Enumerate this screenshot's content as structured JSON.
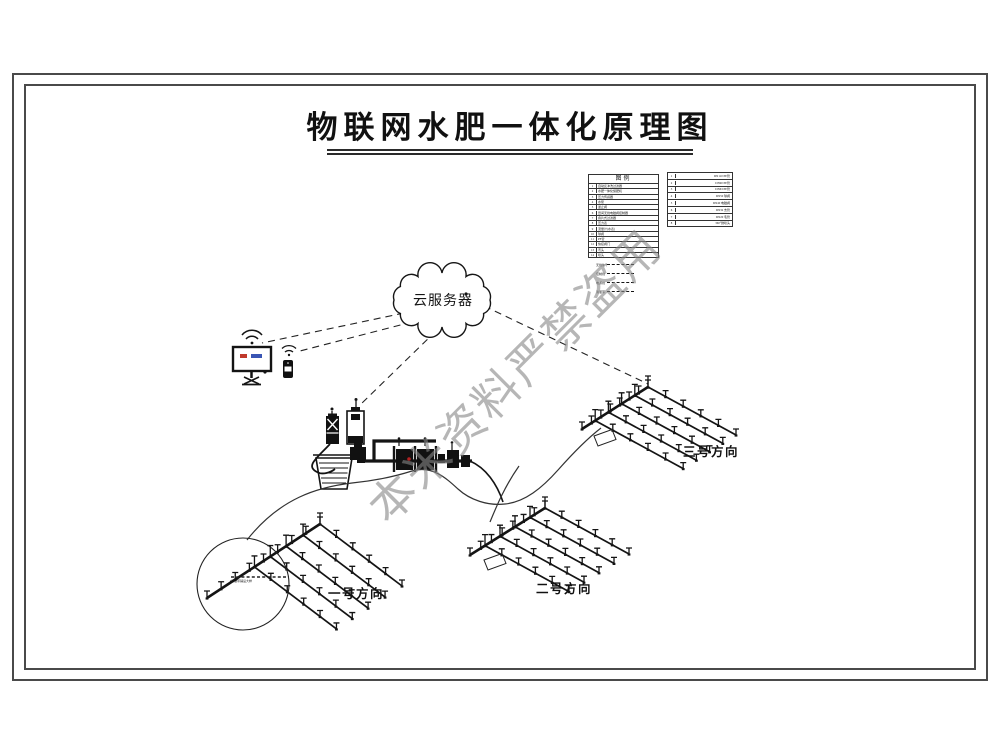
{
  "title": "物联网水肥一体化原理图",
  "watermark": "本米资料严禁盗用",
  "cloud": {
    "label": "云服务器"
  },
  "fields": [
    {
      "label": "一号方向"
    },
    {
      "label": "二号方向"
    },
    {
      "label": "三号方向"
    }
  ],
  "legend": {
    "title": "图例",
    "items": [
      {
        "no": "1",
        "name": "自动反冲洗过滤器"
      },
      {
        "no": "2",
        "name": "水肥一体化施肥机"
      },
      {
        "no": "3",
        "name": "压力传感器"
      },
      {
        "no": "4",
        "name": "水泵"
      },
      {
        "no": "5",
        "name": "逆止阀"
      },
      {
        "no": "6",
        "name": "田间无线电磁阀控制器"
      },
      {
        "no": "7",
        "name": "叠片式过滤器"
      },
      {
        "no": "8",
        "name": "压力表"
      },
      {
        "no": "9",
        "name": "流量计(水表)"
      },
      {
        "no": "10",
        "name": "球阀"
      },
      {
        "no": "11",
        "name": "PE管"
      },
      {
        "no": "12",
        "name": "快接阀门"
      },
      {
        "no": "13",
        "name": "弯头"
      },
      {
        "no": "14",
        "name": "喷头"
      }
    ]
  },
  "spec_table": {
    "rows": [
      {
        "no": "1",
        "name": "DN110 PE管"
      },
      {
        "no": "2",
        "name": "DN90 PE管"
      },
      {
        "no": "3",
        "name": "DN63 PE管"
      },
      {
        "no": "4",
        "name": "DN50 球阀"
      },
      {
        "no": "5",
        "name": "DN40 电磁阀"
      },
      {
        "no": "6",
        "name": "DN32 支管"
      },
      {
        "no": "7",
        "name": "DN20 毛管"
      },
      {
        "no": "8",
        "name": "360°微喷头"
      }
    ]
  },
  "line_legend": [
    {
      "label": "无线信号"
    },
    {
      "label": "控制线"
    },
    {
      "label": "电源线"
    },
    {
      "label": "滴灌带"
    }
  ],
  "callout": {
    "label": "滴灌带铺设大样"
  },
  "colors": {
    "ink": "#141414",
    "frame": "#4a4a4a",
    "watermark": "#878787",
    "monitor_red": "#c0392b",
    "monitor_blue": "#3a55b4",
    "status_dot_red": "#b22222"
  }
}
